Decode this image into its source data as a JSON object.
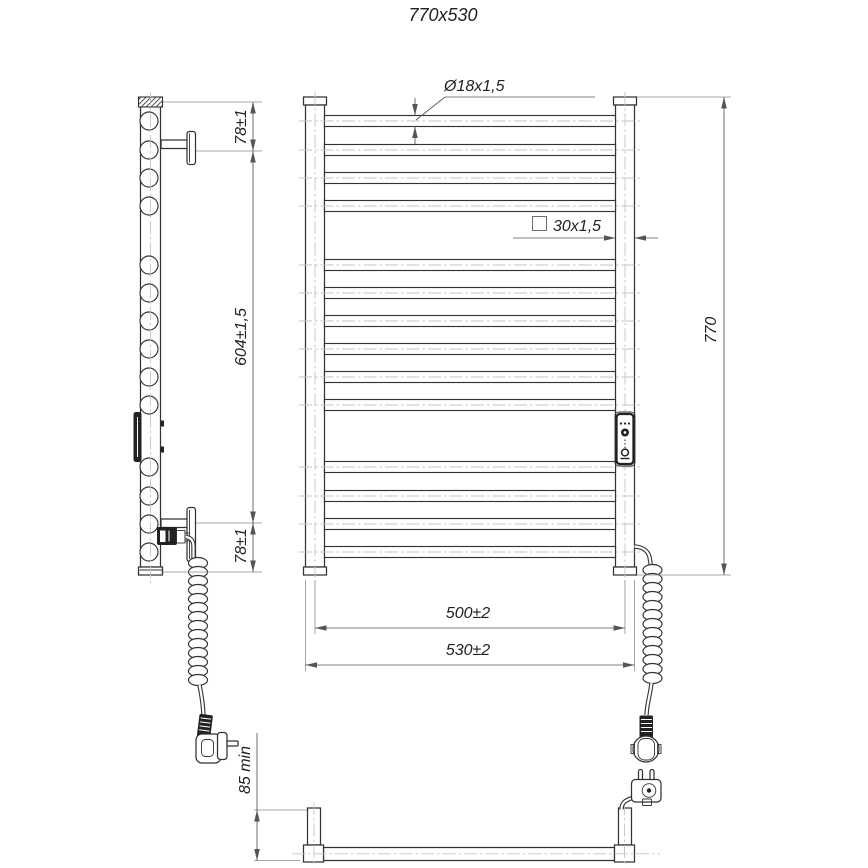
{
  "drawing": {
    "title": "770x530",
    "labels": {
      "tube_diameter": "Ø18x1,5",
      "square_tube": "30x1,5",
      "overall_height": "770",
      "top_bracket_offset": "78±1",
      "bracket_spacing": "604±1,5",
      "bottom_bracket_offset": "78±1",
      "mounting_width": "500±2",
      "overall_width": "530±2",
      "min_clearance": "85 min"
    },
    "colors": {
      "line": "#333333",
      "dimension": "#555555",
      "centerline": "#c4c4c4",
      "background": "#ffffff"
    }
  }
}
